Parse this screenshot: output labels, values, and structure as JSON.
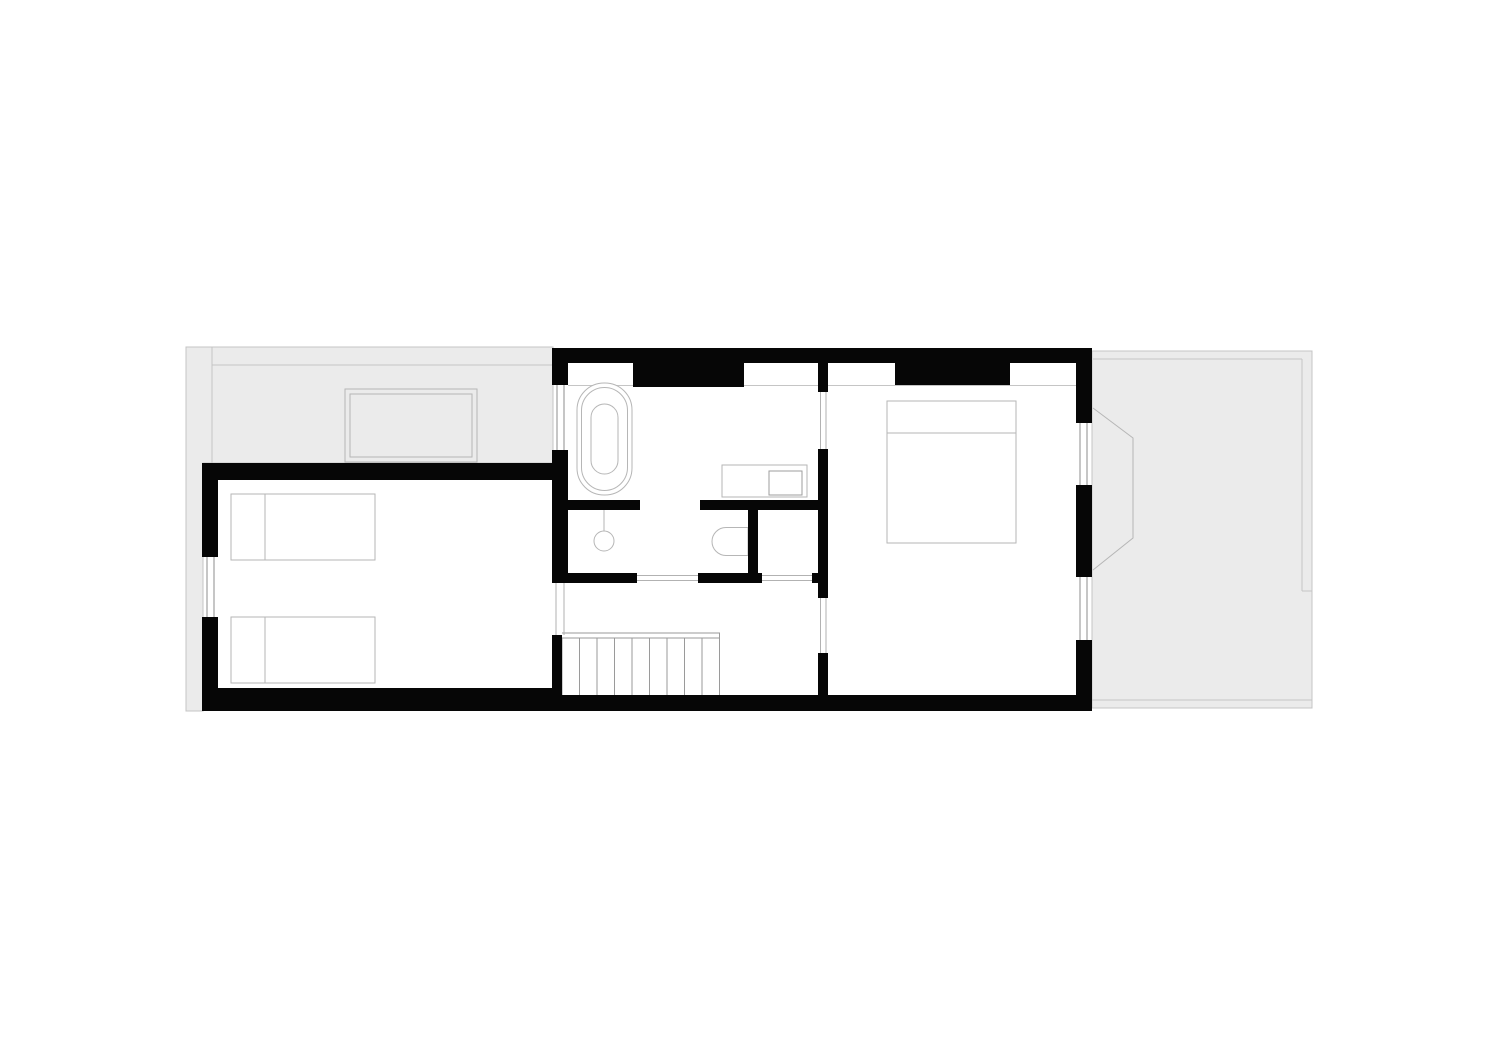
{
  "canvas": {
    "width": 1500,
    "height": 1061,
    "background": "#ffffff"
  },
  "palette": {
    "wall": "#060606",
    "roof_fill": "#ebebeb",
    "roof_line": "#c5c5c5",
    "furniture_line": "#b6b6b6",
    "sink_line": "#9e9e9e",
    "glass_line": "#8c8c8c",
    "door_line": "#b2b2b2",
    "stair_line": "#9a9a9a",
    "white": "#ffffff"
  },
  "shapes": [
    {
      "name": "roof-area-left",
      "type": "path",
      "d": "M186,347 H553 V463 H203 V711 H186 Z",
      "fill": "roof_fill",
      "stroke": "roof_line"
    },
    {
      "name": "roof-area-right",
      "type": "rect",
      "x": 1092,
      "y": 351,
      "w": 220,
      "h": 357,
      "fill": "roof_fill",
      "stroke": "roof_line"
    },
    {
      "name": "roof-edge-line-left-vertical",
      "type": "line",
      "x1": 212,
      "y1": 347,
      "x2": 212,
      "y2": 463,
      "stroke": "roof_line"
    },
    {
      "name": "roof-edge-line-left-horizontal",
      "type": "line",
      "x1": 212,
      "y1": 365,
      "x2": 553,
      "y2": 365,
      "stroke": "roof_line"
    },
    {
      "name": "roof-edge-line-right-top",
      "type": "line",
      "x1": 1093,
      "y1": 359,
      "x2": 1302,
      "y2": 359,
      "stroke": "roof_line"
    },
    {
      "name": "roof-edge-line-right-vertical",
      "type": "line",
      "x1": 1302,
      "y1": 359,
      "x2": 1302,
      "y2": 591,
      "stroke": "roof_line"
    },
    {
      "name": "roof-edge-line-right-stub",
      "type": "line",
      "x1": 1302,
      "y1": 591,
      "x2": 1312,
      "y2": 591,
      "stroke": "roof_line"
    },
    {
      "name": "roof-edge-line-right-bottom",
      "type": "line",
      "x1": 1092,
      "y1": 700,
      "x2": 1312,
      "y2": 700,
      "stroke": "roof_line"
    },
    {
      "name": "bay-window-outline",
      "type": "polyline",
      "points": "1093,408 1133,438 1133,538 1093,570",
      "fill": "none",
      "stroke": "furniture_line"
    },
    {
      "name": "skylight-outer",
      "type": "rect",
      "x": 345,
      "y": 389,
      "w": 132,
      "h": 73,
      "fill": "none",
      "stroke": "furniture_line"
    },
    {
      "name": "skylight-inner",
      "type": "rect",
      "x": 350,
      "y": 394,
      "w": 122,
      "h": 63,
      "fill": "none",
      "stroke": "furniture_line"
    },
    {
      "name": "knee-wall-line",
      "type": "line",
      "x1": 568,
      "y1": 385.5,
      "x2": 1076,
      "y2": 385.5,
      "stroke": "roof_line"
    },
    {
      "name": "bed-single-top",
      "type": "rect",
      "x": 231,
      "y": 494,
      "w": 144,
      "h": 66,
      "fill": "white",
      "stroke": "furniture_line"
    },
    {
      "name": "bed-single-top-pillow-line",
      "type": "line",
      "x1": 265,
      "y1": 494,
      "x2": 265,
      "y2": 560,
      "stroke": "furniture_line"
    },
    {
      "name": "bed-single-bottom",
      "type": "rect",
      "x": 231,
      "y": 617,
      "w": 144,
      "h": 66,
      "fill": "white",
      "stroke": "furniture_line"
    },
    {
      "name": "bed-single-bottom-pillow-line",
      "type": "line",
      "x1": 265,
      "y1": 617,
      "x2": 265,
      "y2": 683,
      "stroke": "furniture_line"
    },
    {
      "name": "bed-double",
      "type": "rect",
      "x": 887,
      "y": 401,
      "w": 129,
      "h": 142,
      "fill": "white",
      "stroke": "furniture_line"
    },
    {
      "name": "bed-double-pillow-line",
      "type": "line",
      "x1": 887,
      "y1": 433,
      "x2": 1016,
      "y2": 433,
      "stroke": "furniture_line"
    },
    {
      "name": "bathtub-outer-rim",
      "type": "rect",
      "x": 577,
      "y": 383,
      "w": 55,
      "h": 112,
      "rx": 27,
      "fill": "white",
      "stroke": "furniture_line"
    },
    {
      "name": "bathtub-inner-rim",
      "type": "rect",
      "x": 581.5,
      "y": 387.5,
      "w": 46,
      "h": 103,
      "rx": 23,
      "fill": "none",
      "stroke": "furniture_line"
    },
    {
      "name": "bathtub-basin",
      "type": "rect",
      "x": 591,
      "y": 404,
      "w": 27,
      "h": 70,
      "rx": 13.5,
      "fill": "none",
      "stroke": "furniture_line"
    },
    {
      "name": "shower-arm",
      "type": "line",
      "x1": 604,
      "y1": 510,
      "x2": 604,
      "y2": 531,
      "stroke": "furniture_line"
    },
    {
      "name": "shower-head",
      "type": "circle",
      "cx": 604,
      "cy": 541,
      "r": 10,
      "fill": "white",
      "stroke": "furniture_line"
    },
    {
      "name": "vanity-counter",
      "type": "rect",
      "x": 722,
      "y": 465,
      "w": 85,
      "h": 32,
      "fill": "white",
      "stroke": "furniture_line"
    },
    {
      "name": "vanity-sink",
      "type": "rect",
      "x": 769,
      "y": 471,
      "w": 33,
      "h": 24,
      "fill": "none",
      "stroke": "sink_line"
    },
    {
      "name": "toilet",
      "type": "path",
      "d": "M748,527.5 H726 A14,14 0 0 0 726,555.5 H748 Z",
      "fill": "white",
      "stroke": "furniture_line"
    },
    {
      "name": "stair-handrail-line-a",
      "type": "line",
      "x1": 562,
      "y1": 633,
      "x2": 720,
      "y2": 633,
      "stroke": "stair_line"
    },
    {
      "name": "stair-handrail-line-b",
      "type": "line",
      "x1": 562,
      "y1": 638,
      "x2": 720,
      "y2": 638,
      "stroke": "stair_line"
    },
    {
      "name": "stair-tread-1",
      "type": "line",
      "x1": 562,
      "y1": 638,
      "x2": 562,
      "y2": 697,
      "stroke": "stair_line"
    },
    {
      "name": "stair-tread-2",
      "type": "line",
      "x1": 579.5,
      "y1": 638,
      "x2": 579.5,
      "y2": 697,
      "stroke": "stair_line"
    },
    {
      "name": "stair-tread-3",
      "type": "line",
      "x1": 597,
      "y1": 638,
      "x2": 597,
      "y2": 697,
      "stroke": "stair_line"
    },
    {
      "name": "stair-tread-4",
      "type": "line",
      "x1": 614.5,
      "y1": 638,
      "x2": 614.5,
      "y2": 697,
      "stroke": "stair_line"
    },
    {
      "name": "stair-tread-5",
      "type": "line",
      "x1": 632,
      "y1": 638,
      "x2": 632,
      "y2": 697,
      "stroke": "stair_line"
    },
    {
      "name": "stair-tread-6",
      "type": "line",
      "x1": 649.5,
      "y1": 638,
      "x2": 649.5,
      "y2": 697,
      "stroke": "stair_line"
    },
    {
      "name": "stair-tread-7",
      "type": "line",
      "x1": 667,
      "y1": 638,
      "x2": 667,
      "y2": 697,
      "stroke": "stair_line"
    },
    {
      "name": "stair-tread-8",
      "type": "line",
      "x1": 684.5,
      "y1": 638,
      "x2": 684.5,
      "y2": 697,
      "stroke": "stair_line"
    },
    {
      "name": "stair-tread-9",
      "type": "line",
      "x1": 702,
      "y1": 638,
      "x2": 702,
      "y2": 697,
      "stroke": "stair_line"
    },
    {
      "name": "stair-tread-10",
      "type": "line",
      "x1": 719.5,
      "y1": 633,
      "x2": 719.5,
      "y2": 697,
      "stroke": "stair_line"
    },
    {
      "name": "window-left-room-glass-a",
      "type": "line",
      "x1": 207,
      "y1": 557,
      "x2": 207,
      "y2": 617,
      "stroke": "glass_line"
    },
    {
      "name": "window-left-room-glass-b",
      "type": "line",
      "x1": 214,
      "y1": 557,
      "x2": 214,
      "y2": 617,
      "stroke": "glass_line"
    },
    {
      "name": "window-bath-west-glass-a",
      "type": "line",
      "x1": 557,
      "y1": 385,
      "x2": 557,
      "y2": 450,
      "stroke": "glass_line"
    },
    {
      "name": "window-bath-west-glass-b",
      "type": "line",
      "x1": 564,
      "y1": 385,
      "x2": 564,
      "y2": 450,
      "stroke": "glass_line"
    },
    {
      "name": "window-bedroom-east-1-glass-a",
      "type": "line",
      "x1": 1080,
      "y1": 423,
      "x2": 1080,
      "y2": 485,
      "stroke": "glass_line"
    },
    {
      "name": "window-bedroom-east-1-glass-b",
      "type": "line",
      "x1": 1087,
      "y1": 423,
      "x2": 1087,
      "y2": 485,
      "stroke": "glass_line"
    },
    {
      "name": "window-bedroom-east-2-glass-a",
      "type": "line",
      "x1": 1080,
      "y1": 577,
      "x2": 1080,
      "y2": 640,
      "stroke": "glass_line"
    },
    {
      "name": "window-bedroom-east-2-glass-b",
      "type": "line",
      "x1": 1087,
      "y1": 577,
      "x2": 1087,
      "y2": 640,
      "stroke": "glass_line"
    },
    {
      "name": "door-opening-left-room-a",
      "type": "line",
      "x1": 556,
      "y1": 583,
      "x2": 556,
      "y2": 635,
      "stroke": "door_line"
    },
    {
      "name": "door-opening-left-room-b",
      "type": "line",
      "x1": 564,
      "y1": 583,
      "x2": 564,
      "y2": 635,
      "stroke": "door_line"
    },
    {
      "name": "door-opening-bathroom-a",
      "type": "line",
      "x1": 637,
      "y1": 575.5,
      "x2": 698,
      "y2": 575.5,
      "stroke": "door_line"
    },
    {
      "name": "door-opening-bathroom-b",
      "type": "line",
      "x1": 637,
      "y1": 580.5,
      "x2": 698,
      "y2": 580.5,
      "stroke": "door_line"
    },
    {
      "name": "closet-opening-a",
      "type": "line",
      "x1": 762,
      "y1": 575.5,
      "x2": 812,
      "y2": 575.5,
      "stroke": "door_line"
    },
    {
      "name": "closet-opening-b",
      "type": "line",
      "x1": 762,
      "y1": 580.5,
      "x2": 812,
      "y2": 580.5,
      "stroke": "door_line"
    },
    {
      "name": "door-opening-bath-bedroom-a",
      "type": "line",
      "x1": 820.5,
      "y1": 392,
      "x2": 820.5,
      "y2": 449,
      "stroke": "door_line"
    },
    {
      "name": "door-opening-bath-bedroom-b",
      "type": "line",
      "x1": 826,
      "y1": 392,
      "x2": 826,
      "y2": 449,
      "stroke": "door_line"
    },
    {
      "name": "door-opening-landing-bedroom-a",
      "type": "line",
      "x1": 820.5,
      "y1": 598,
      "x2": 820.5,
      "y2": 653,
      "stroke": "door_line"
    },
    {
      "name": "door-opening-landing-bedroom-b",
      "type": "line",
      "x1": 826,
      "y1": 598,
      "x2": 826,
      "y2": 653,
      "stroke": "door_line"
    },
    {
      "name": "wall-top",
      "type": "rect",
      "x": 552,
      "y": 348,
      "w": 540,
      "h": 15,
      "fill": "wall"
    },
    {
      "name": "wall-chimney-bath",
      "type": "rect",
      "x": 633,
      "y": 348,
      "w": 111,
      "h": 39,
      "fill": "wall"
    },
    {
      "name": "wall-chimney-bedroom",
      "type": "rect",
      "x": 895,
      "y": 348,
      "w": 115,
      "h": 37,
      "fill": "wall"
    },
    {
      "name": "wall-west-top",
      "type": "rect",
      "x": 552,
      "y": 348,
      "w": 16,
      "h": 37,
      "fill": "wall"
    },
    {
      "name": "wall-west-mid",
      "type": "rect",
      "x": 552,
      "y": 450,
      "w": 16,
      "h": 133,
      "fill": "wall"
    },
    {
      "name": "wall-west-stair",
      "type": "rect",
      "x": 552,
      "y": 635,
      "w": 10,
      "h": 62,
      "fill": "wall"
    },
    {
      "name": "wall-left-room-top",
      "type": "rect",
      "x": 202,
      "y": 463,
      "w": 366,
      "h": 17,
      "fill": "wall"
    },
    {
      "name": "wall-left-room-west-upper",
      "type": "rect",
      "x": 202,
      "y": 463,
      "w": 16,
      "h": 94,
      "fill": "wall"
    },
    {
      "name": "wall-left-room-west-lower",
      "type": "rect",
      "x": 202,
      "y": 617,
      "w": 16,
      "h": 94,
      "fill": "wall"
    },
    {
      "name": "wall-bottom-left",
      "type": "rect",
      "x": 202,
      "y": 688,
      "w": 351,
      "h": 23,
      "fill": "wall"
    },
    {
      "name": "wall-bottom-main",
      "type": "rect",
      "x": 552,
      "y": 695,
      "w": 540,
      "h": 16,
      "fill": "wall"
    },
    {
      "name": "wall-east-segment-1",
      "type": "rect",
      "x": 1076,
      "y": 352,
      "w": 16,
      "h": 71,
      "fill": "wall"
    },
    {
      "name": "wall-east-segment-2",
      "type": "rect",
      "x": 1076,
      "y": 485,
      "w": 16,
      "h": 92,
      "fill": "wall"
    },
    {
      "name": "wall-east-segment-3",
      "type": "rect",
      "x": 1076,
      "y": 640,
      "w": 16,
      "h": 71,
      "fill": "wall"
    },
    {
      "name": "wall-divider-top",
      "type": "rect",
      "x": 818,
      "y": 348,
      "w": 10,
      "h": 44,
      "fill": "wall"
    },
    {
      "name": "wall-divider-mid",
      "type": "rect",
      "x": 818,
      "y": 449,
      "w": 10,
      "h": 149,
      "fill": "wall"
    },
    {
      "name": "wall-divider-low",
      "type": "rect",
      "x": 818,
      "y": 653,
      "w": 10,
      "h": 44,
      "fill": "wall"
    },
    {
      "name": "wall-shower-stub",
      "type": "rect",
      "x": 568,
      "y": 500,
      "w": 72,
      "h": 10,
      "fill": "wall"
    },
    {
      "name": "wall-toilet-top",
      "type": "rect",
      "x": 700,
      "y": 500,
      "w": 128,
      "h": 10,
      "fill": "wall"
    },
    {
      "name": "wall-toilet-right",
      "type": "rect",
      "x": 748,
      "y": 500,
      "w": 10,
      "h": 83,
      "fill": "wall"
    },
    {
      "name": "wall-bath-bottom-a",
      "type": "rect",
      "x": 552,
      "y": 573,
      "w": 85,
      "h": 10,
      "fill": "wall"
    },
    {
      "name": "wall-bath-bottom-b",
      "type": "rect",
      "x": 698,
      "y": 573,
      "w": 64,
      "h": 10,
      "fill": "wall"
    },
    {
      "name": "wall-bath-bottom-c",
      "type": "rect",
      "x": 812,
      "y": 573,
      "w": 16,
      "h": 10,
      "fill": "wall"
    }
  ]
}
